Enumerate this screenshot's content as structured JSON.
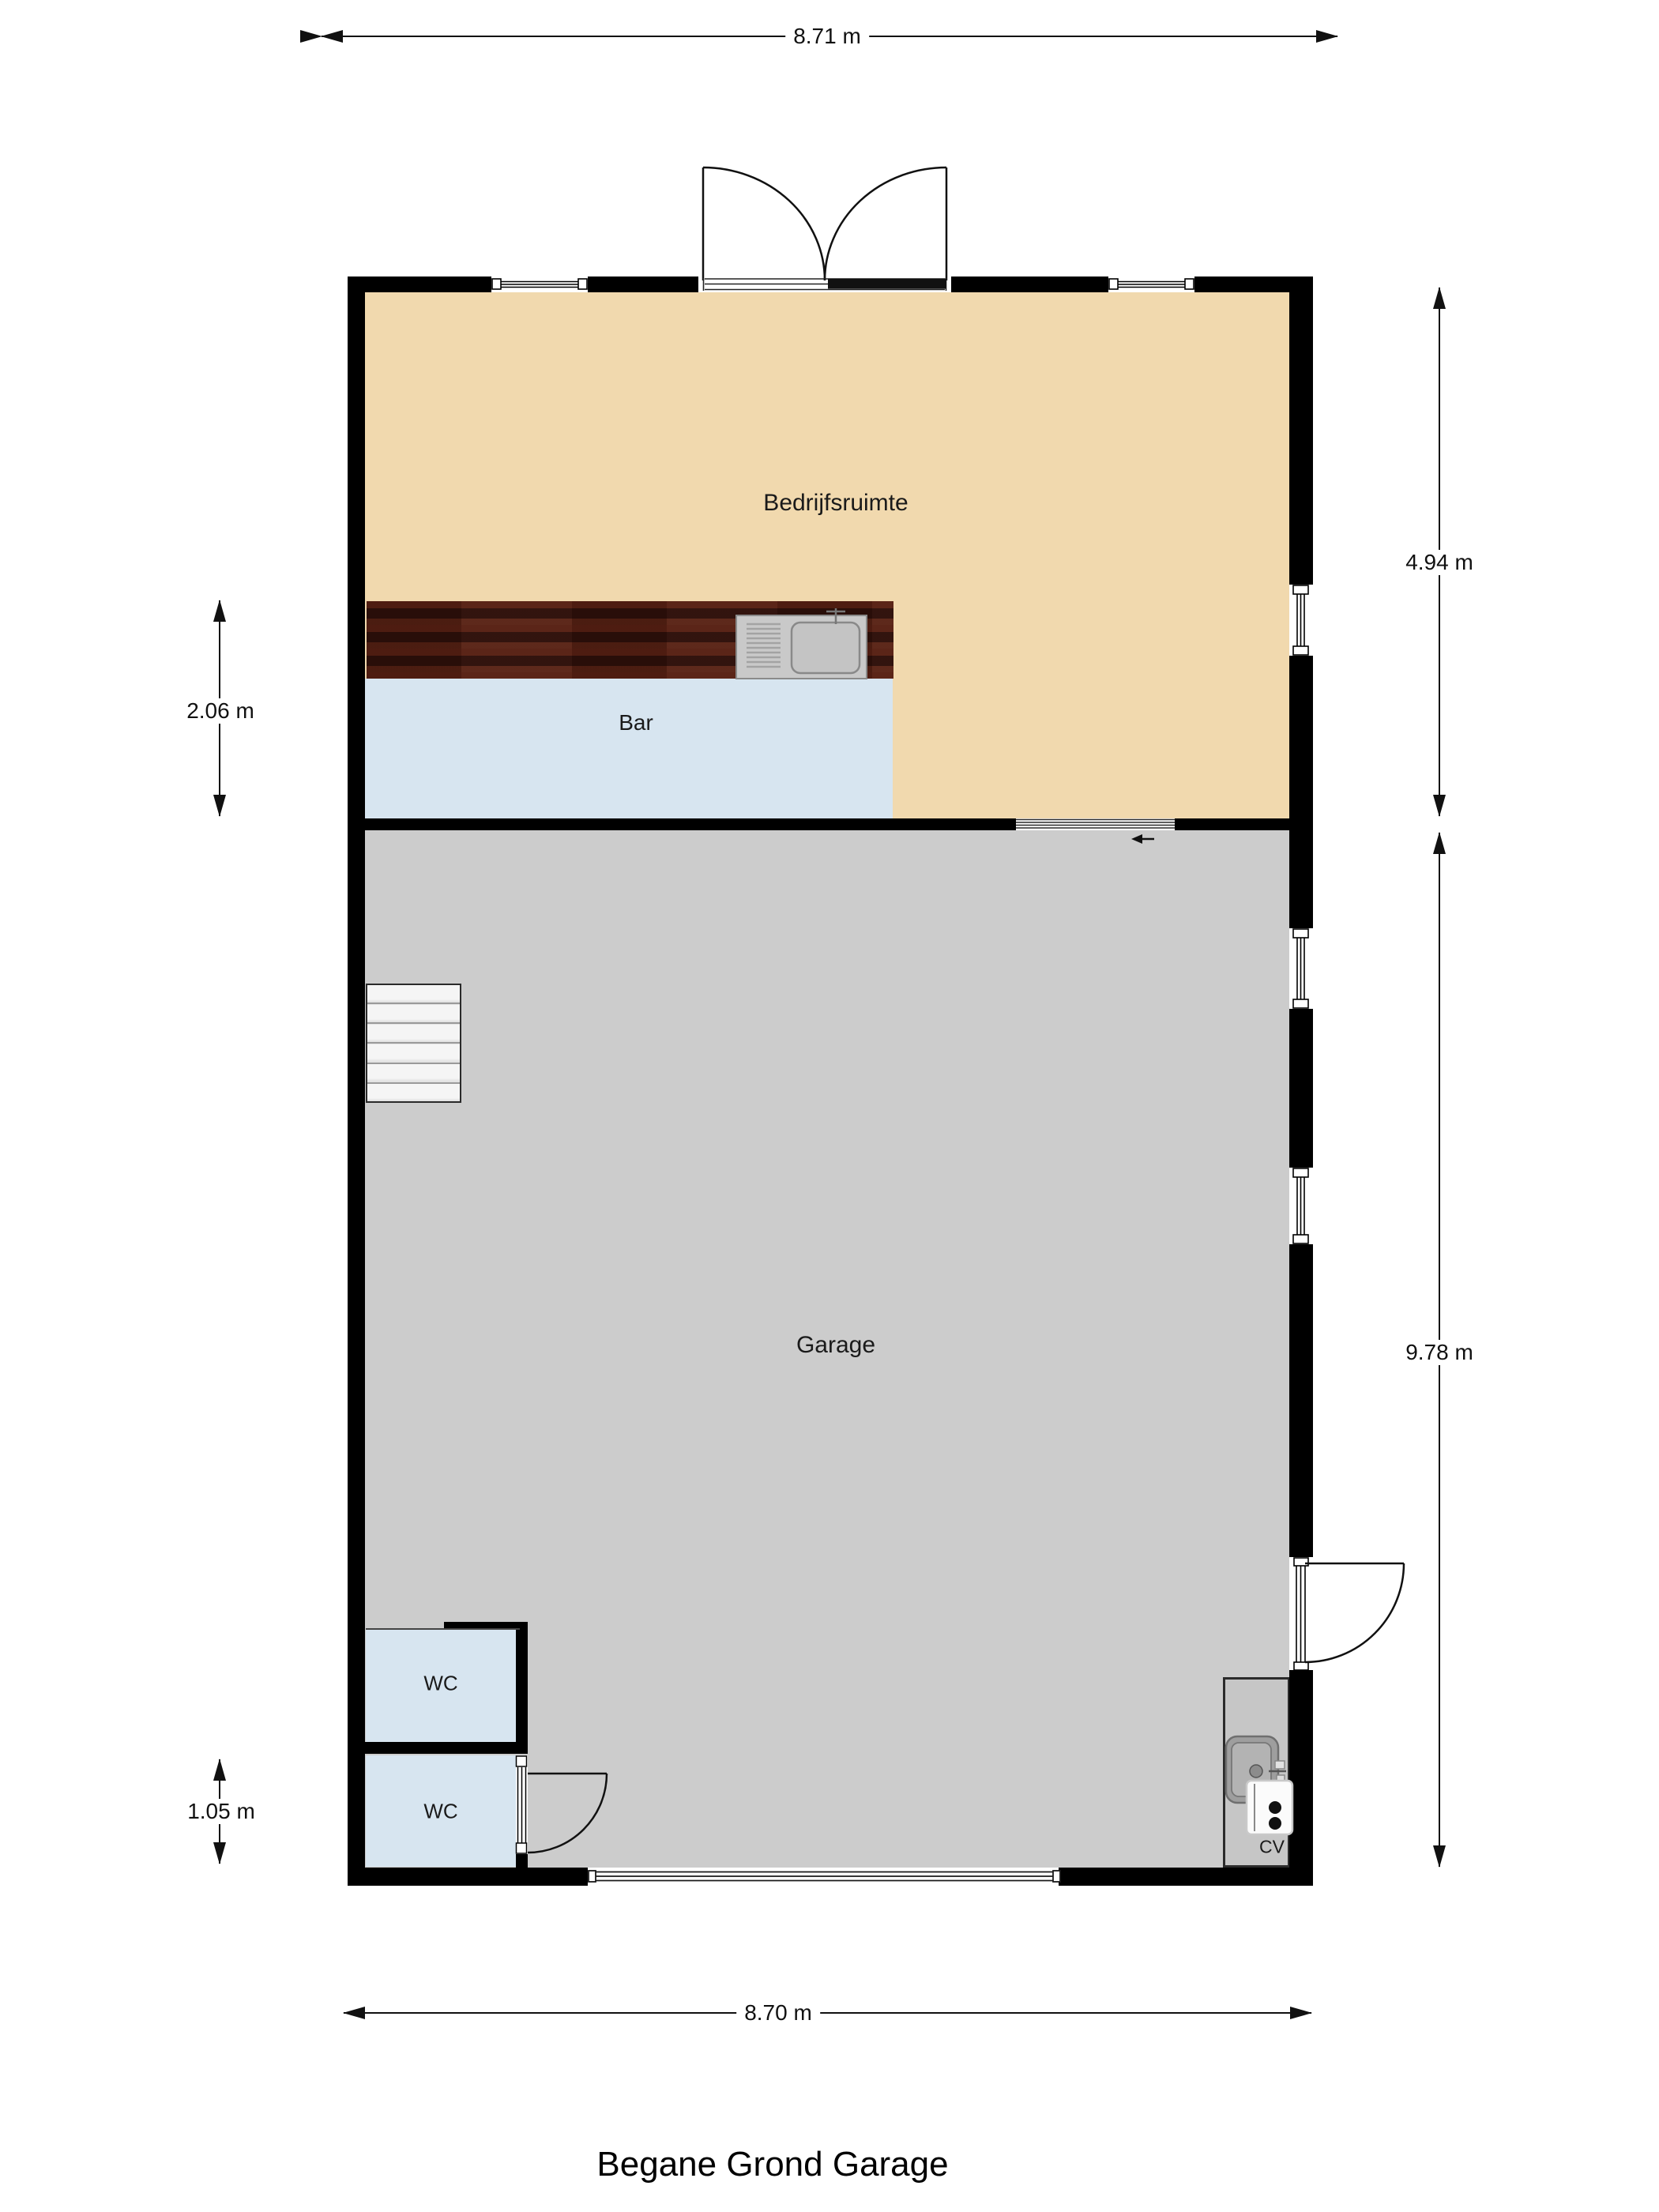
{
  "title": "Begane Grond Garage",
  "rooms": {
    "bedrijfsruimte": {
      "label": "Bedrijfsruimte"
    },
    "bar": {
      "label": "Bar"
    },
    "garage": {
      "label": "Garage"
    },
    "wc_upper": {
      "label": "WC"
    },
    "wc_lower": {
      "label": "WC"
    },
    "cv": {
      "label": "CV"
    }
  },
  "dimensions": {
    "top_width": "8.71 m",
    "bottom_width": "8.70 m",
    "bar_height_left": "2.06 m",
    "wc_height_left": "1.05 m",
    "right_upper_height": "4.94 m",
    "right_lower_height": "9.78 m"
  },
  "colors": {
    "bedrijfsruimte_fill": "#F1D9AE",
    "bar_fill": "#D7E5F0",
    "wc_fill": "#D7E5F0",
    "garage_fill": "#CCCCCC",
    "cv_fill": "#C6C6C6",
    "wall": "#000000",
    "counter_wood": "#40180F",
    "stairs_fill": "#EEEEEE"
  }
}
